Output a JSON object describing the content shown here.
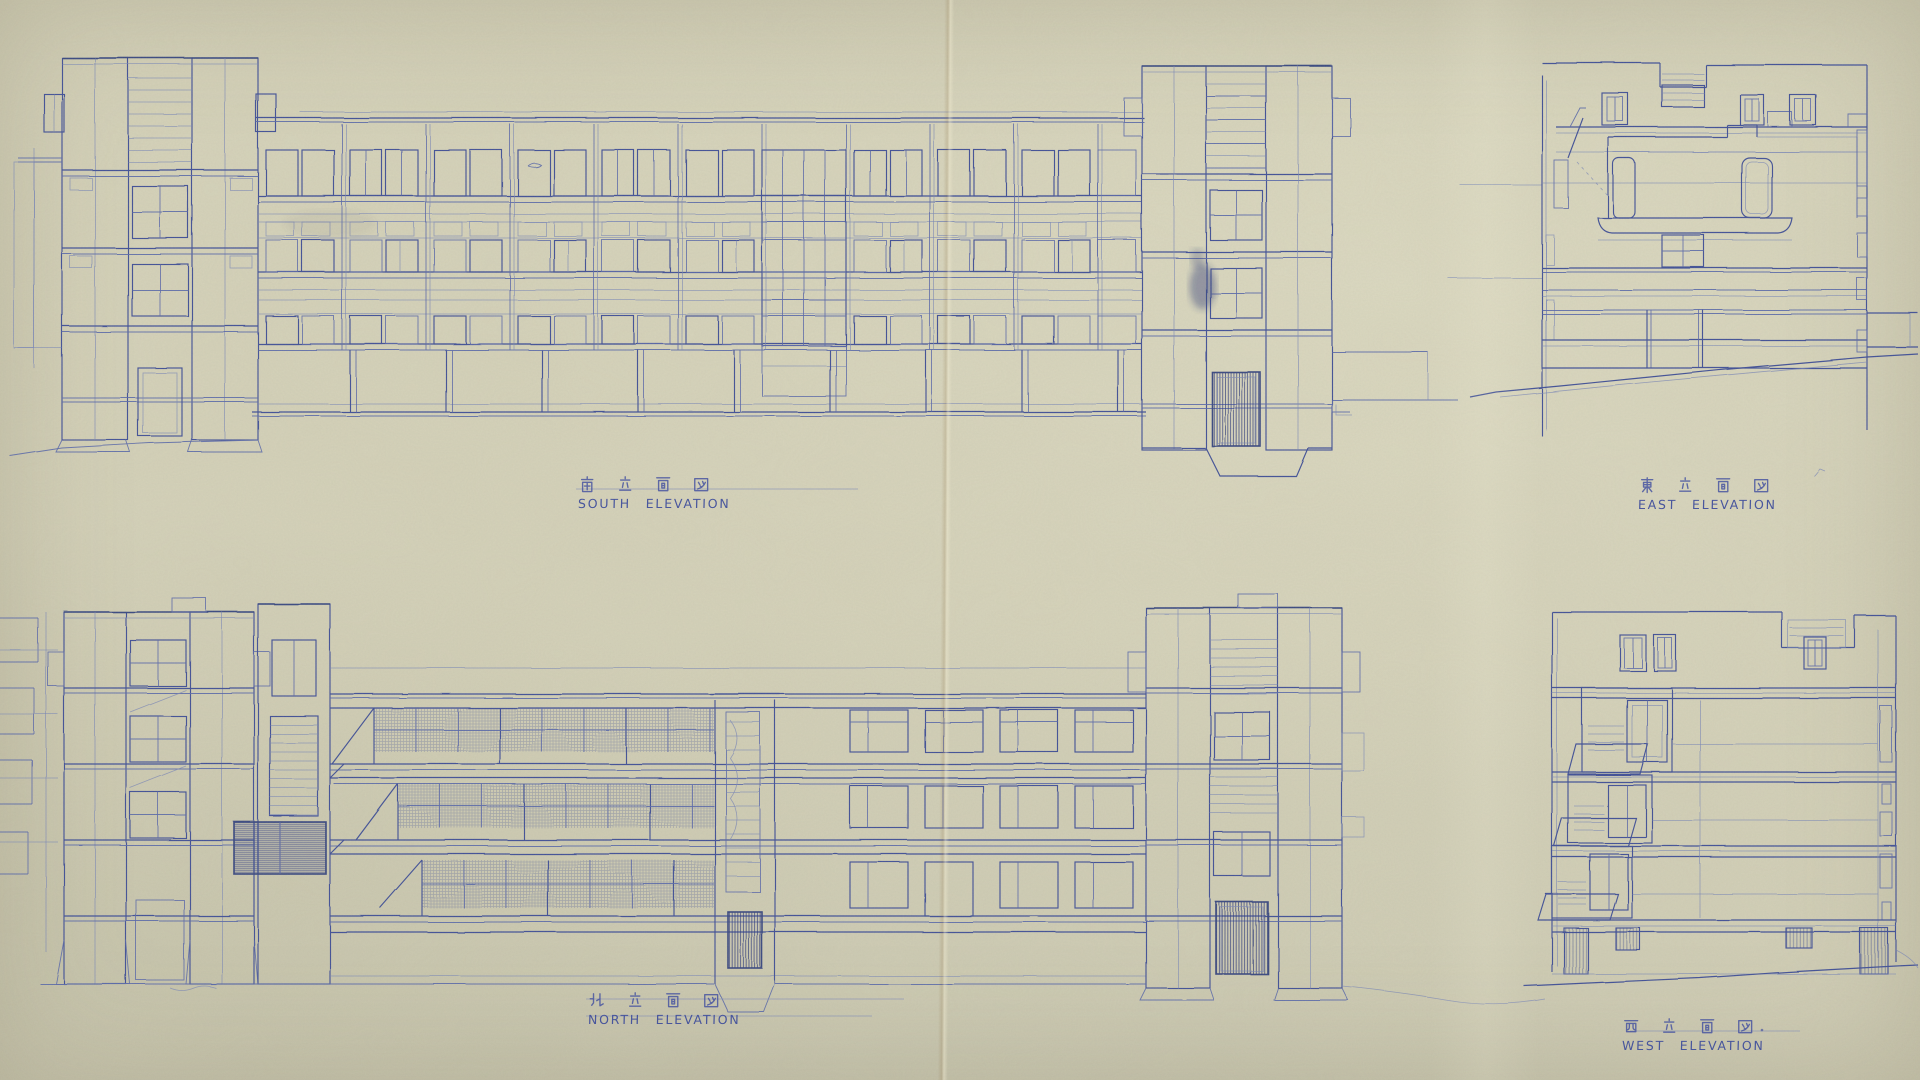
{
  "sheet": {
    "description_visible": "four hand-drafted building elevations on aged blueprint paper",
    "labels": {
      "south": {
        "jp": "南立面図",
        "en": "SOUTH ELEVATION"
      },
      "east": {
        "jp": "東立面図",
        "en": "EAST ELEVATION"
      },
      "north": {
        "jp": "北立面図",
        "en": "NORTH ELEVATION"
      },
      "west": {
        "jp": "西立面図",
        "en": "WEST ELEVATION"
      }
    }
  },
  "palette": {
    "paper": "#d5d2b9",
    "ink": "#3f4f96",
    "ink_dark": "#37477f",
    "ink_mid": "#5a68a8",
    "ink_faint": "#7a86b6",
    "ink_text": "#3d4c9b",
    "crease": "#8a6c3e"
  }
}
